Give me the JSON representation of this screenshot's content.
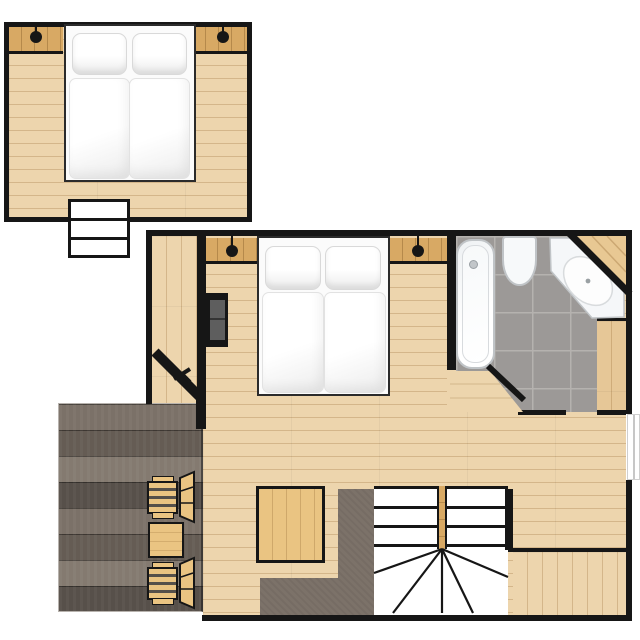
{
  "plan": {
    "type": "apartment-floor-plan",
    "sections": [
      {
        "name": "upper-bedroom",
        "furniture": [
          "double-bed",
          "pillow",
          "pillow",
          "duvet",
          "duvet",
          "nightstand-left",
          "nightstand-right",
          "wall-lamp-left",
          "wall-lamp-right",
          "entry-steps"
        ]
      },
      {
        "name": "main-unit",
        "rooms": [
          "bedroom",
          "entry-corridor",
          "bathroom",
          "staircase",
          "terrace"
        ],
        "furniture": [
          "double-bed",
          "nightstand-left",
          "nightstand-right",
          "wall-lamp-left",
          "wall-lamp-right",
          "armchair",
          "wardrobe",
          "entrance-door"
        ],
        "bathroom_fixtures": [
          "bathtub",
          "toilet",
          "corner-vanity-sink"
        ],
        "terrace_furniture": [
          "deck-chair",
          "side-table",
          "deck-chair"
        ]
      }
    ]
  },
  "colors": {
    "wall": "#161616",
    "floor": "#edd5ad",
    "floor-dark": "#e6c797",
    "floor-line": "rgba(146,103,48,0.28)",
    "nightstand": "#d8a964",
    "furniture": "#eac482",
    "deck-base": "#6e655e",
    "taupe": "#7c7269",
    "tile": "#9c9997",
    "grout": "#b5b2af",
    "fixture": "#f7f9fa",
    "fixture-border": "#c0c4c7",
    "sofa-seat": "#5e5e5e",
    "bedding": "#ffffff"
  }
}
